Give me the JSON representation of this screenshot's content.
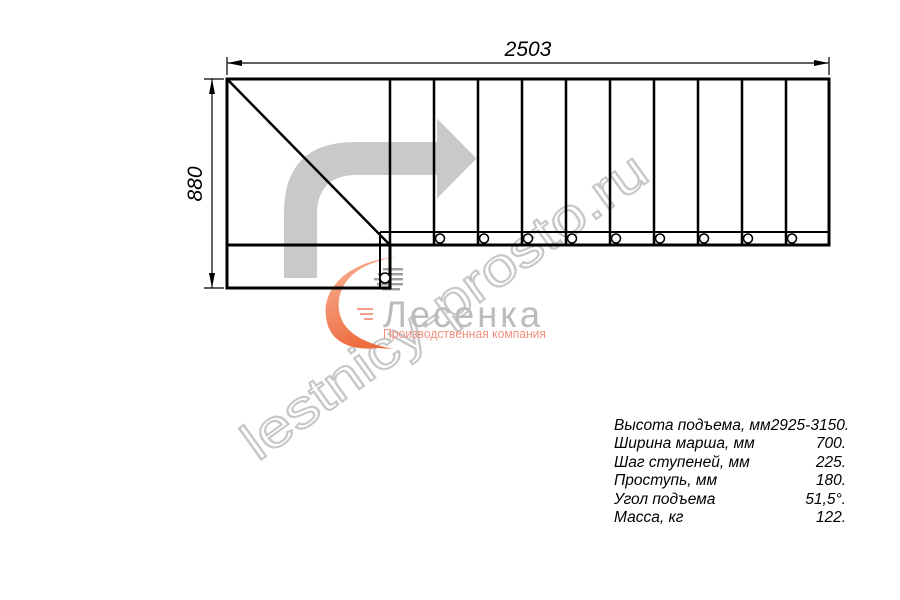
{
  "diagram": {
    "type": "staircase-plan-top-view",
    "width_label": "2503",
    "height_label": "880",
    "tread_count": 10,
    "stringer_hole_count": 9
  },
  "watermark": "lestnicy-prosto.ru",
  "logo": {
    "name": "Лесенка",
    "tagline": "Производственная компания"
  },
  "specs": [
    {
      "label": "Высота подъема, мм",
      "value": "2925-3150."
    },
    {
      "label": "Ширина марша, мм",
      "value": "700."
    },
    {
      "label": "Шаг ступеней, мм",
      "value": "225."
    },
    {
      "label": "Проступь, мм",
      "value": "180."
    },
    {
      "label": "Угол подъема",
      "value": "51,5°."
    },
    {
      "label": "Масса, кг",
      "value": "122."
    }
  ],
  "colors": {
    "line": "#000000",
    "direction_arrow": "#c9c9c9",
    "watermark_outline": "#c7c7c7",
    "logo_gray": "#bcbcbc",
    "logo_salmon": "#f2907f",
    "swoosh_light": "#f9b69a",
    "swoosh_dark": "#ed6d3f"
  }
}
